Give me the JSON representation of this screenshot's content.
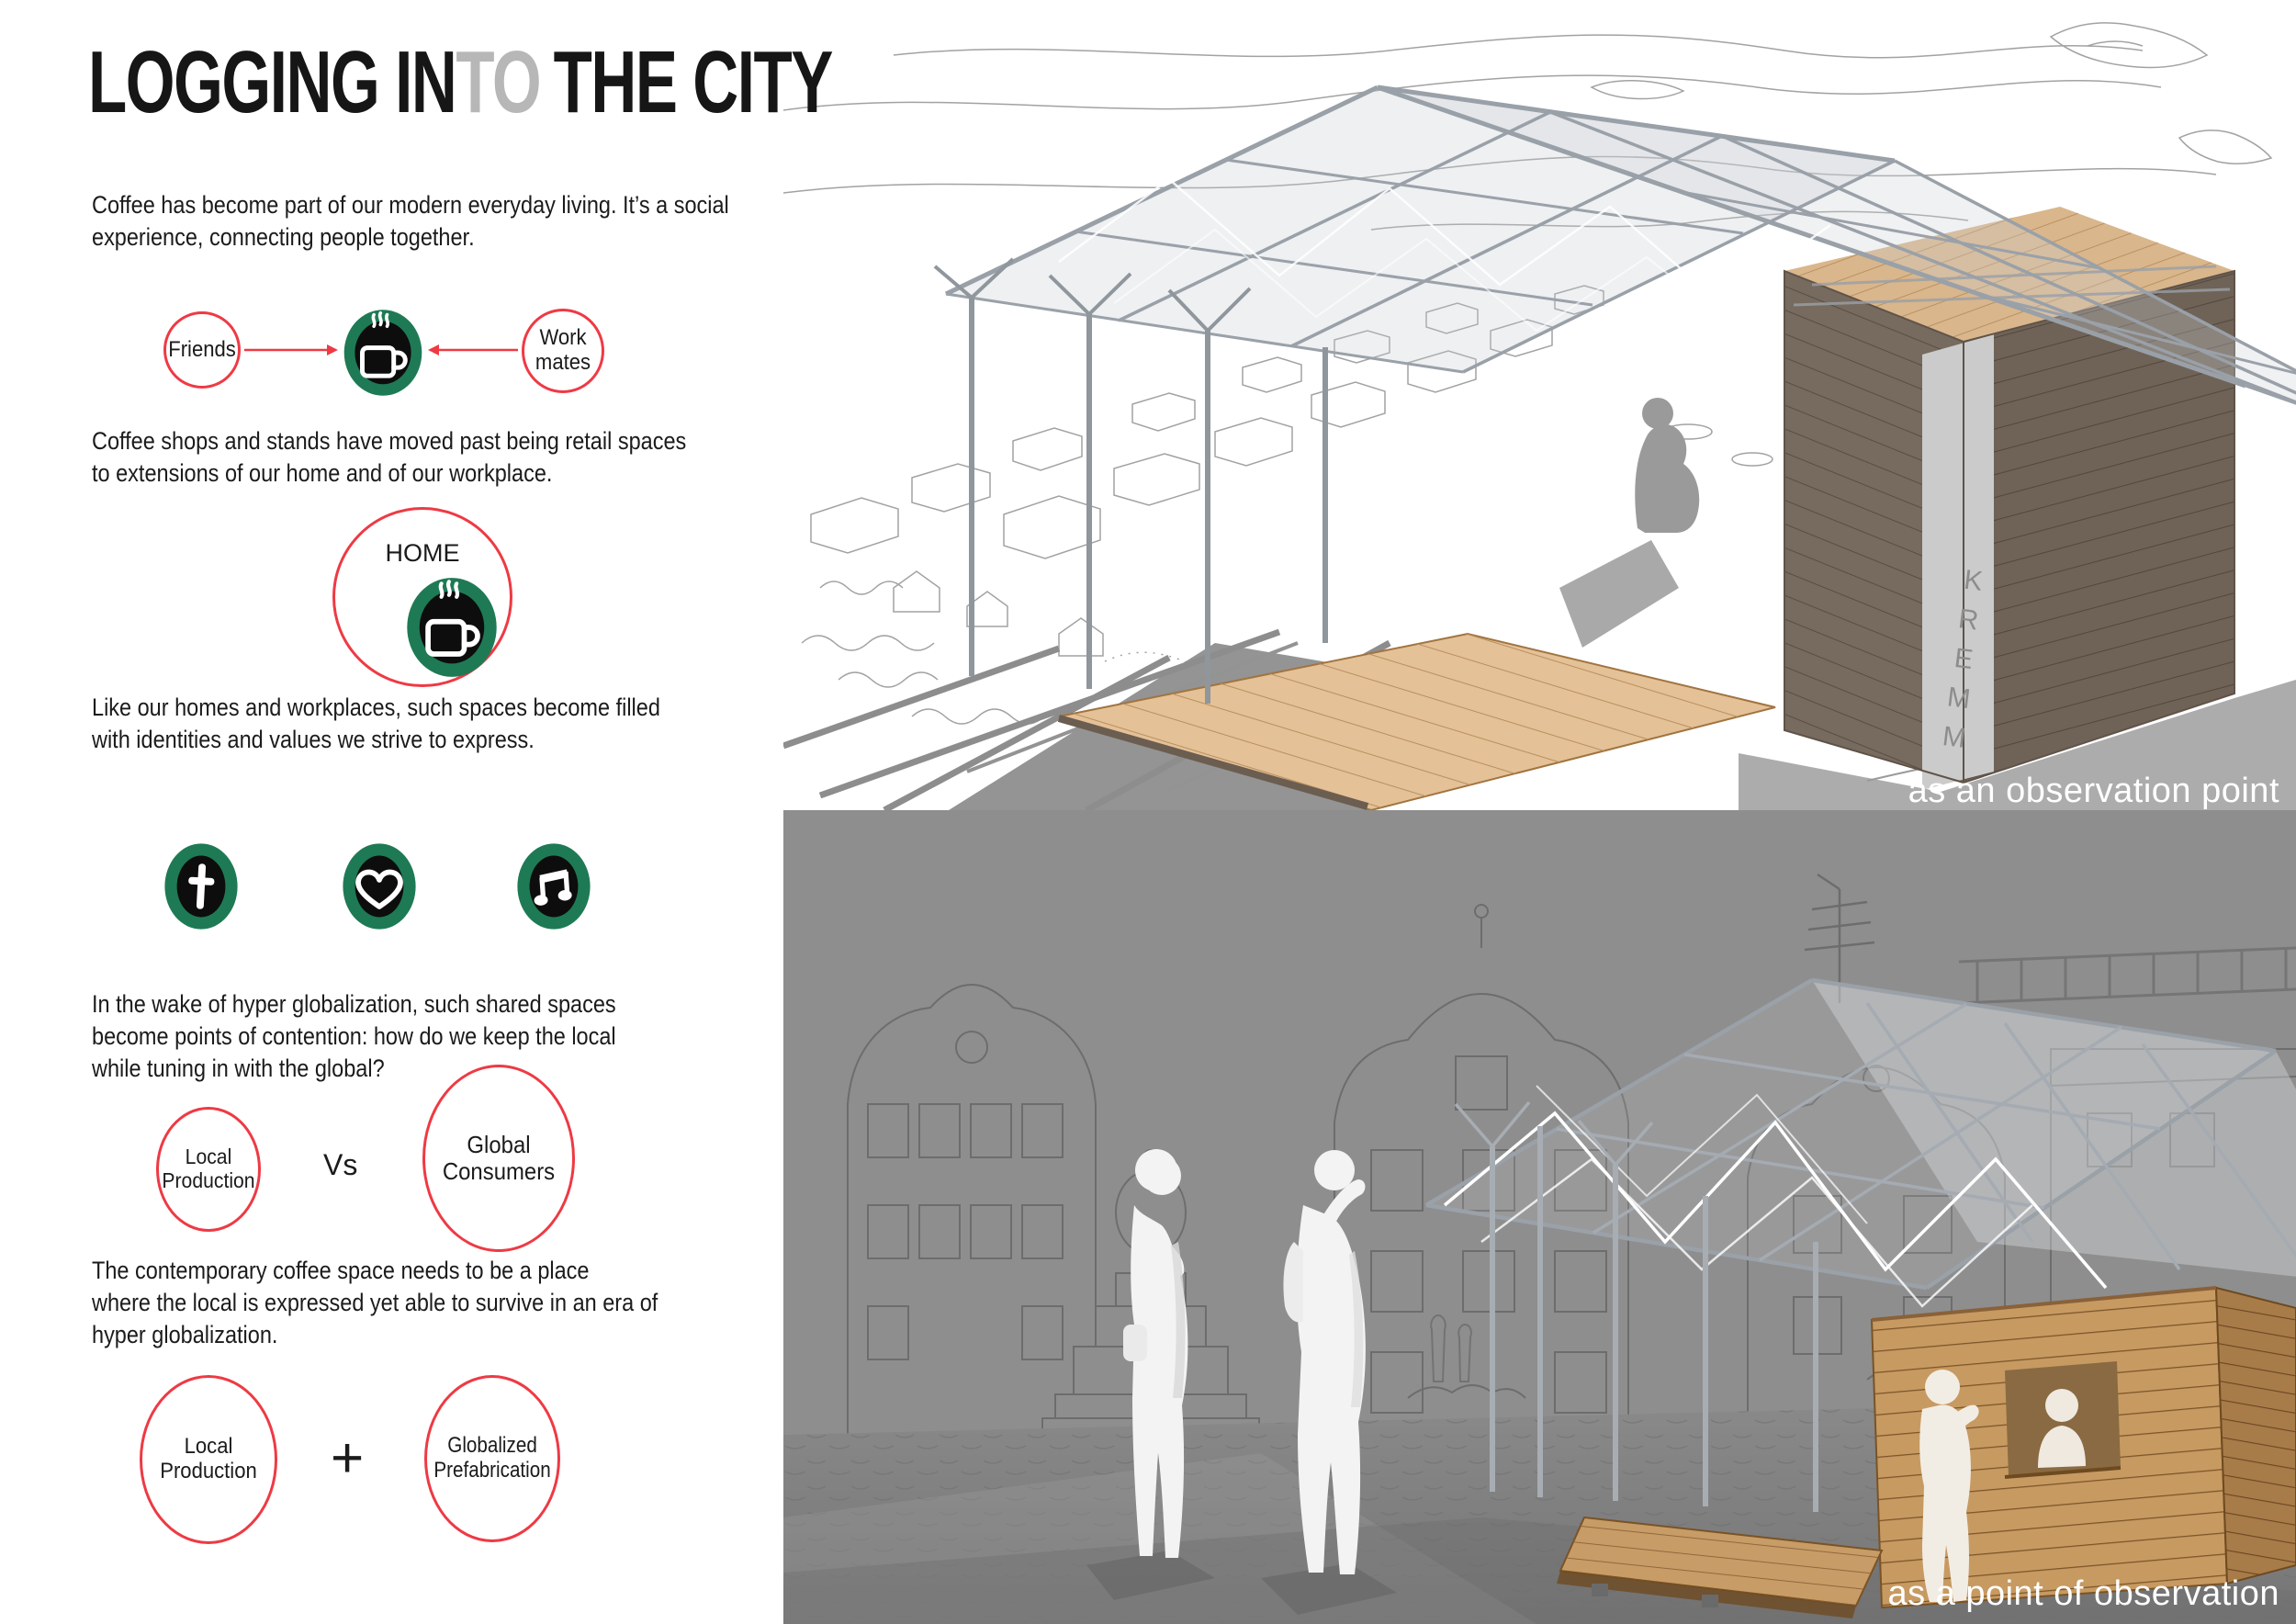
{
  "title": {
    "part1": "LOGGING IN",
    "part2": "TO",
    "part3": "THE CITY"
  },
  "paragraphs": {
    "p1": [
      "Coffee has become part of our modern everyday living. It’s a social",
      "experience, connecting people together."
    ],
    "p2": [
      "Coffee shops and stands have moved past being retail spaces",
      "to extensions of our home and of our workplace."
    ],
    "p3": [
      "Like our homes and workplaces, such spaces become filled",
      "with identities and values we strive to express."
    ],
    "p4": [
      "In the wake of hyper globalization, such shared spaces",
      "become points of contention: how do we keep the local",
      "while tuning in with the global?"
    ],
    "p5": [
      "The contemporary coffee space needs to be a place",
      "where the local is expressed yet able to survive in an era of",
      "hyper globalization."
    ]
  },
  "diagram_social": {
    "left_label": "Friends",
    "right_label": "Work mates"
  },
  "diagram_home": {
    "label": "HOME"
  },
  "diagram_versus": {
    "left": "Local Production",
    "vs": "Vs",
    "right": "Global Consumers"
  },
  "diagram_plus": {
    "left": "Local Production",
    "plus": "+",
    "right": "Globalized Prefabrication"
  },
  "icons": {
    "center": "coffee-cup-icon",
    "identity": [
      "cross-icon",
      "heart-icon",
      "music-note-icon"
    ]
  },
  "renders": {
    "top": {
      "caption": "as an observation point",
      "kiosk_signage": "KREMM"
    },
    "bottom": {
      "caption": "as a point of observation"
    }
  },
  "colors": {
    "accent_red": "#ee3a44",
    "brand_green": "#1e7a55",
    "title_gray": "#b7b7b7",
    "panel_gray": "#8e8e8e",
    "icon_inner_black": "#0d0d0d"
  }
}
